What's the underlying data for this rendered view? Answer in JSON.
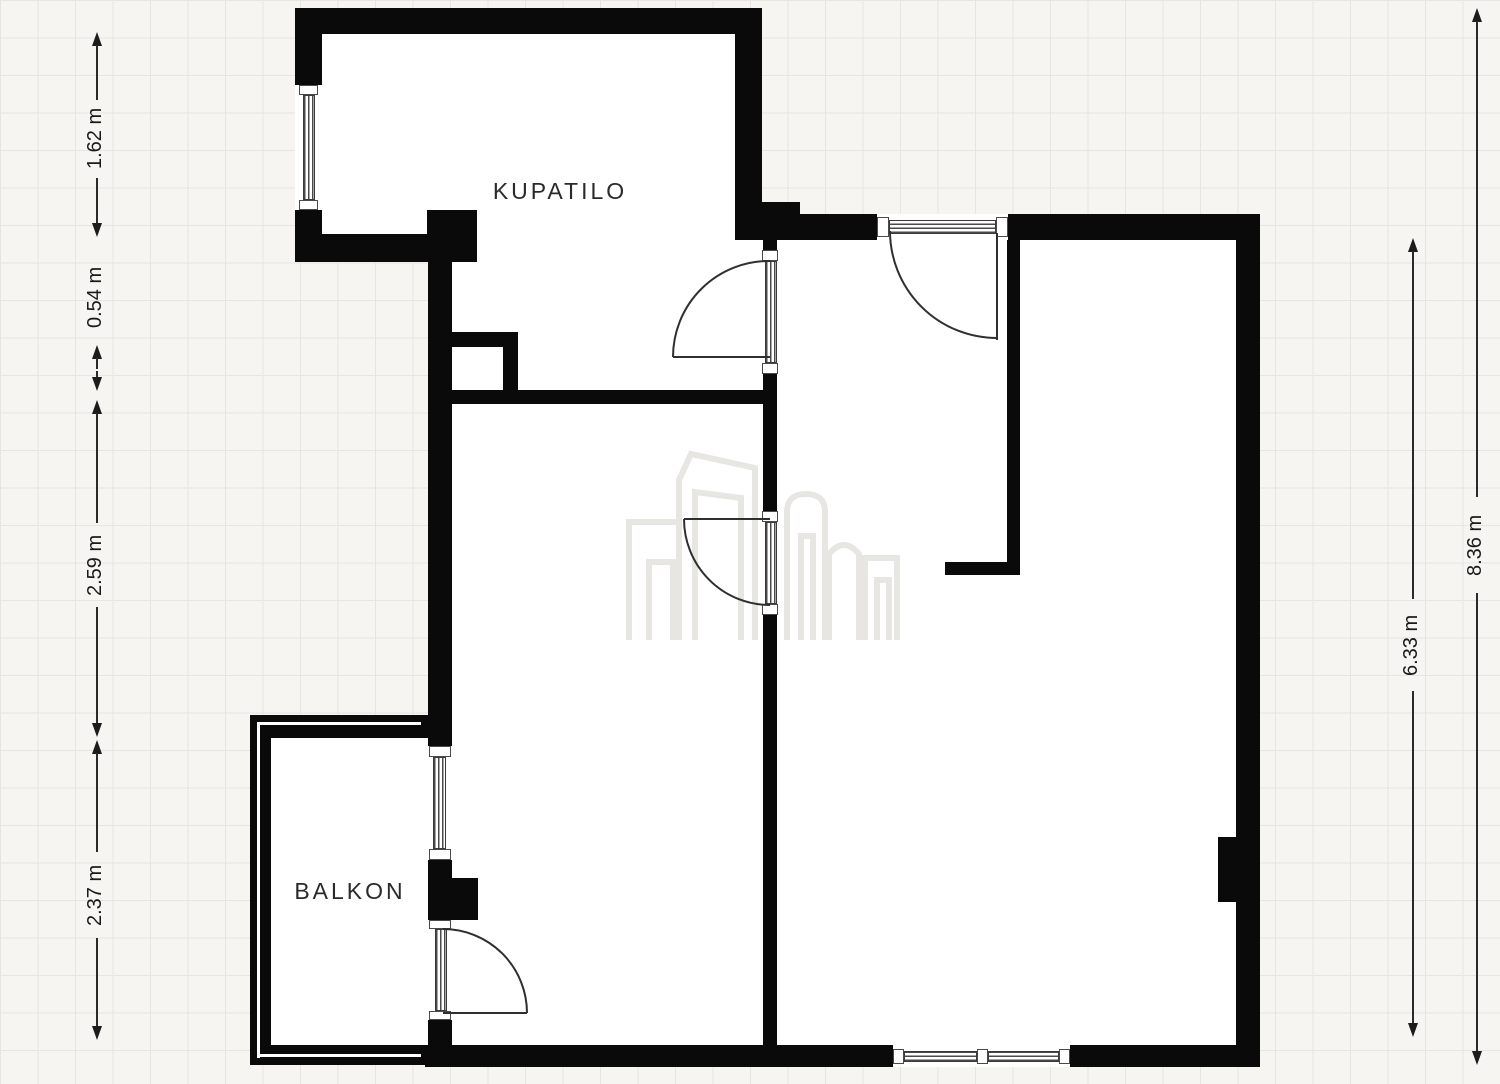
{
  "rooms": [
    {
      "id": "kupatilo",
      "label": "KUPATILO"
    },
    {
      "id": "balkon",
      "label": "BALKON"
    }
  ],
  "dimensions": {
    "left": [
      "1.62 m",
      "0.54 m",
      "2.59 m",
      "2.37 m"
    ],
    "right": [
      "6.33 m",
      "8.36 m"
    ]
  },
  "colors": {
    "wall": "#0a0a0a",
    "floor": "#ffffff",
    "background": "#f6f5f2",
    "grid_line": "#e7e5e2",
    "dimension_text": "#1a1a1a",
    "watermark": "#e8e6e3"
  }
}
